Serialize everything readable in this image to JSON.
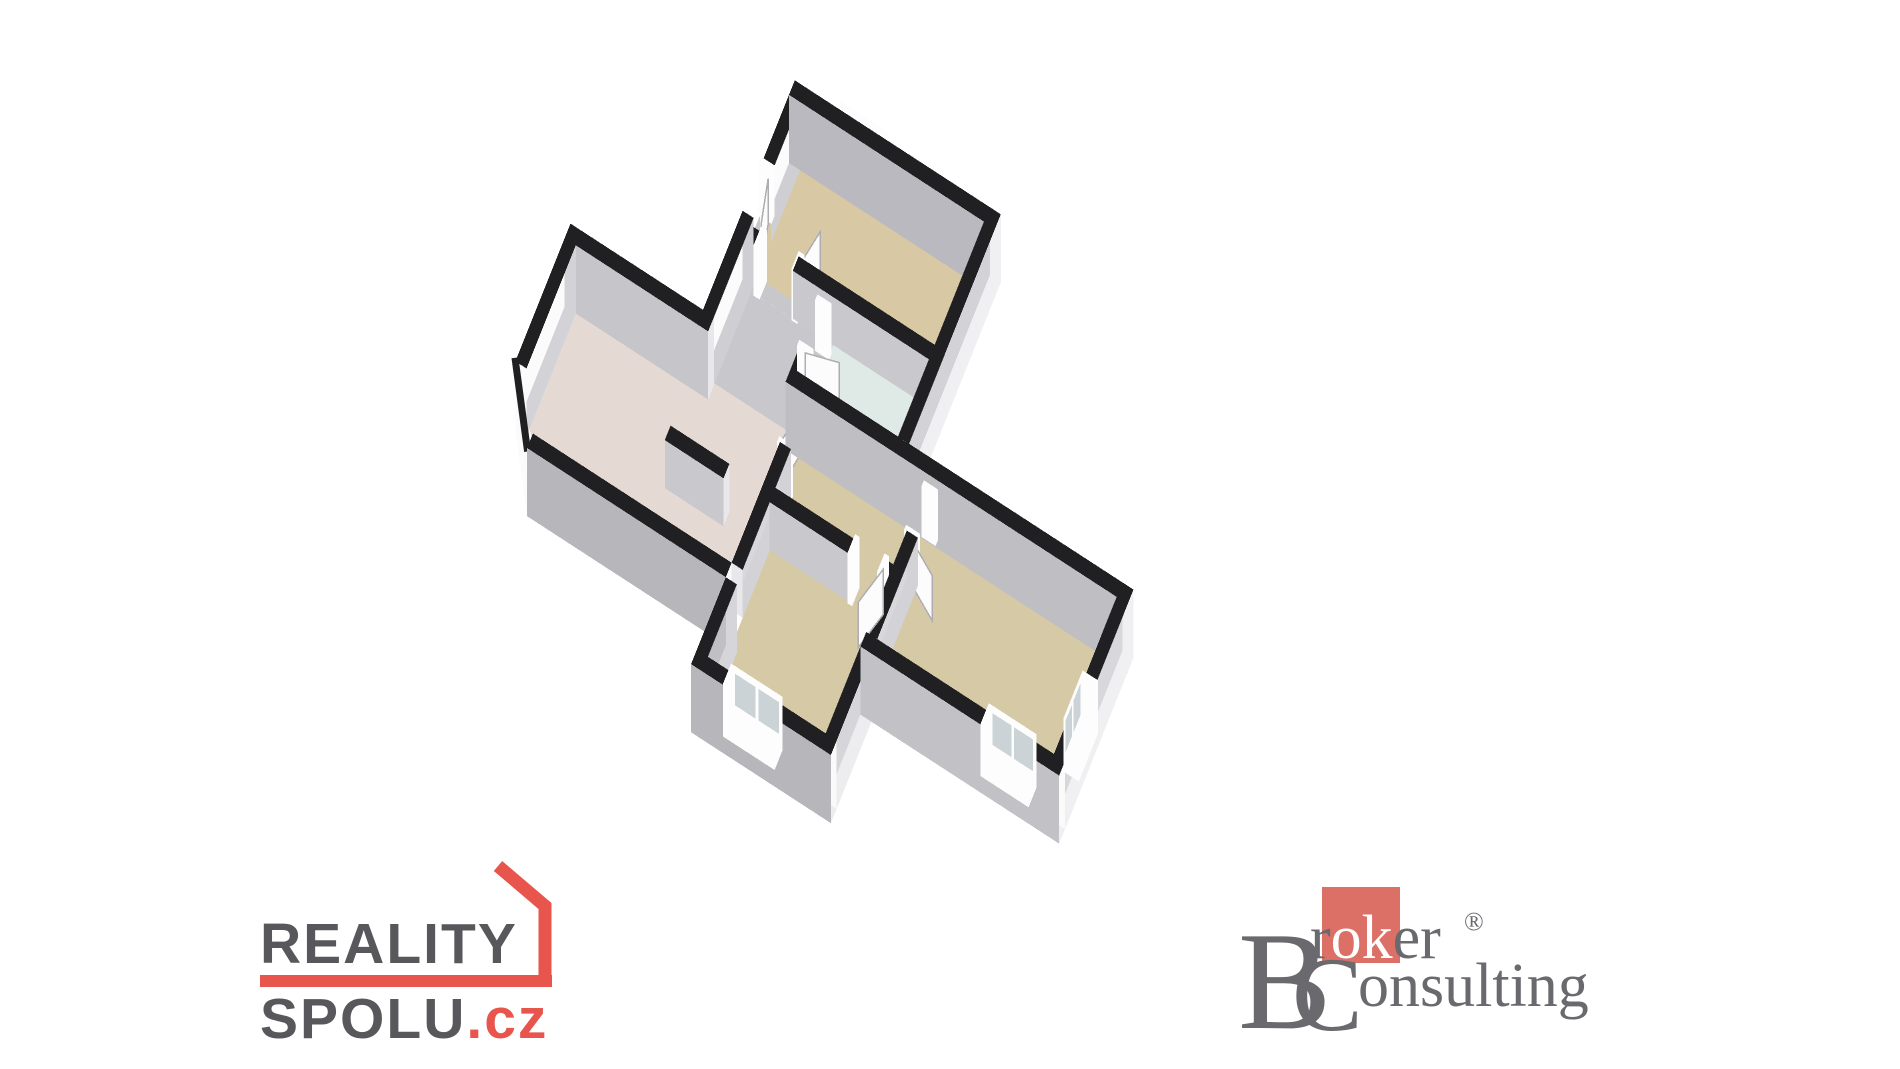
{
  "page": {
    "background": "#ffffff"
  },
  "floorplan": {
    "proj": {
      "ox": 800,
      "oy": 150,
      "s": 46,
      "ux": 0.8,
      "uy": 0.52,
      "vx": -0.42,
      "vy": 1.05,
      "h": 48,
      "ext": 0.42
    },
    "colors": {
      "wall_top": "#202022",
      "frame": "#fdfdfd",
      "pane": "#ccd3d6",
      "leaf": "#fcfcfc",
      "leaf_edge": "#aeaeb2",
      "floor_tan": "#d6c9a6",
      "floor_kitchen": "#d8c9a4",
      "floor_pink": "#e5d9d3",
      "floor_gray": "#c8c8cc",
      "floor_blue": "#dfe9e5"
    },
    "rooms": [
      {
        "name": "kitchen",
        "fill": "#d8c9a4",
        "rect": [
          0,
          0,
          5.0,
          2.55
        ]
      },
      {
        "name": "entry-hall",
        "fill": "#c8c8cc",
        "rect": [
          0,
          2.85,
          2.1,
          4.45
        ]
      },
      {
        "name": "hall-junction",
        "fill": "#c8c8cc",
        "rect": [
          0,
          4.45,
          2.1,
          4.75
        ]
      },
      {
        "name": "hall-kitchen-doorway",
        "fill": "#c8c8cc",
        "rect": [
          0.4,
          2.55,
          1.3,
          2.85
        ]
      },
      {
        "name": "entrance-doorway",
        "fill": "#c8c8cc",
        "rect": [
          -0.3,
          1.5,
          0,
          2.4
        ]
      },
      {
        "name": "bathroom-doorway",
        "fill": "#c8c8cc",
        "rect": [
          2.1,
          3.1,
          2.4,
          4.0
        ]
      },
      {
        "name": "bathroom",
        "fill": "#dfe9e5",
        "rect": [
          2.4,
          2.85,
          5.0,
          4.45
        ]
      },
      {
        "name": "living-room",
        "fill": "#e5d9d3",
        "poly": [
          [
            -3.6,
            4.75
          ],
          [
            2.5,
            4.75
          ],
          [
            2.5,
            8.3
          ],
          [
            -2.6,
            8.3
          ],
          [
            -3.6,
            7.3
          ]
        ]
      },
      {
        "name": "corridor",
        "fill": "#d6c9a6",
        "rect": [
          2.8,
          4.75,
          6.0,
          6.6
        ]
      },
      {
        "name": "living-doorway",
        "fill": "#d6c9a6",
        "rect": [
          2.5,
          4.9,
          2.8,
          5.8
        ]
      },
      {
        "name": "bedroom2-doorway",
        "fill": "#d6c9a6",
        "rect": [
          6.0,
          5.0,
          6.3,
          5.9
        ]
      },
      {
        "name": "bedroom1-doorway",
        "fill": "#d6c9a6",
        "rect": [
          5.0,
          6.6,
          5.8,
          6.9
        ]
      },
      {
        "name": "bedroom-1",
        "fill": "#d6c9a6",
        "rect": [
          2.8,
          6.9,
          6.0,
          10.1
        ]
      },
      {
        "name": "bedroom-2",
        "fill": "#d6c9a6",
        "rect": [
          6.3,
          4.75,
          11.1,
          8.0
        ]
      }
    ],
    "walls": [
      {
        "name": "upper-north",
        "x0": -0.3,
        "x1": 5.3,
        "y0": -0.3,
        "y1": 0,
        "ext": true,
        "n": "#fbfbfb",
        "s": "#b9b9bf",
        "e": "#f0f0f2"
      },
      {
        "name": "upper-west-a",
        "x0": -0.3,
        "x1": 0,
        "y0": -0.3,
        "y1": 1.5,
        "ext": true,
        "w": "#fbfbfb",
        "e": "#cfcfd3"
      },
      {
        "name": "upper-west-b",
        "x0": -0.3,
        "x1": 0,
        "y0": 2.4,
        "y1": 4.45,
        "ext": true,
        "w": "#fbfbfb",
        "e": "#cfcfd3",
        "n": "#f5f5f7"
      },
      {
        "name": "upper-east",
        "x0": 5.0,
        "x1": 5.3,
        "y0": -0.3,
        "y1": 4.45,
        "ext": true,
        "w": "#d3d3d7",
        "e": "#f0f0f2",
        "s": "#e8e8ea"
      },
      {
        "name": "main-north-w",
        "x0": -3.9,
        "x1": 0,
        "y0": 4.45,
        "y1": 4.75,
        "ext": true,
        "n": "#fbfbfb",
        "s": "#c6c6ca",
        "w": "#fafafa",
        "e": "#e8e8ea"
      },
      {
        "name": "main-north-e",
        "x0": 2.1,
        "x1": 11.4,
        "y0": 4.45,
        "y1": 4.75,
        "ext": true,
        "n": "#fbfbfb",
        "s": "#bfbfc3",
        "e": "#f0f0f2",
        "w": "#e8e8ea"
      },
      {
        "name": "main-west",
        "x0": -3.9,
        "x1": -3.6,
        "y0": 4.75,
        "y1": 7.3,
        "ext": true,
        "w": "#fbfbfb",
        "e": "#d3d3d7"
      },
      {
        "name": "living-south",
        "x0": -2.9,
        "x1": 2.5,
        "y0": 8.3,
        "y1": 8.6,
        "ext": true,
        "n": "#fafafa",
        "s": "#b7b7bb",
        "w": "#f5f5f7"
      },
      {
        "name": "bed1-west-ext",
        "x0": 2.5,
        "x1": 2.8,
        "y0": 8.6,
        "y1": 10.4,
        "ext": true,
        "w": "#c0c0c4",
        "e": "#d6d6da"
      },
      {
        "name": "bed1-south",
        "x0": 2.5,
        "x1": 6.3,
        "y0": 10.1,
        "y1": 10.4,
        "ext": true,
        "n": "#fafafa",
        "s": "#b7b7bb"
      },
      {
        "name": "bed1-east",
        "x0": 6.0,
        "x1": 6.3,
        "y0": 8.3,
        "y1": 10.4,
        "ext": true,
        "w": "#d6d6da",
        "e": "#ededef",
        "s": "#e8e8ea"
      },
      {
        "name": "bed2-south",
        "x0": 6.0,
        "x1": 11.4,
        "y0": 8.0,
        "y1": 8.3,
        "ext": true,
        "n": "#fafafa",
        "s": "#c2c2c6"
      },
      {
        "name": "bed2-east",
        "x0": 11.1,
        "x1": 11.4,
        "y0": 4.45,
        "y1": 8.3,
        "ext": true,
        "w": "#d8d8dc",
        "e": "#f0f0f2"
      },
      {
        "name": "kitchen-south-a",
        "x0": 0,
        "x1": 0.4,
        "y0": 2.55,
        "y1": 2.85,
        "n": "#fafafa",
        "s": "#c9c9cd",
        "e": "#e8e8ea"
      },
      {
        "name": "kitchen-south-b",
        "x0": 1.3,
        "x1": 5.0,
        "y0": 2.55,
        "y1": 2.85,
        "n": "#fafafa",
        "s": "#c9c9cd",
        "w": "#e8e8ea"
      },
      {
        "name": "hall-bath-a",
        "x0": 2.1,
        "x1": 2.4,
        "y0": 2.85,
        "y1": 3.1,
        "w": "#d8d8dc",
        "e": "#cfcfd3",
        "s": "#e8e8ea"
      },
      {
        "name": "hall-bath-b",
        "x0": 2.1,
        "x1": 2.4,
        "y0": 4.0,
        "y1": 4.45,
        "w": "#d8d8dc",
        "e": "#cfcfd3",
        "n": "#f5f5f7"
      },
      {
        "name": "living-corr-a",
        "x0": 2.5,
        "x1": 2.8,
        "y0": 4.75,
        "y1": 4.9,
        "w": "#d8d8dc",
        "e": "#d3d3d7"
      },
      {
        "name": "living-corr-b",
        "x0": 2.5,
        "x1": 2.8,
        "y0": 5.8,
        "y1": 8.3,
        "w": "#d8d8dc",
        "e": "#d3d3d7",
        "n": "#f5f5f7",
        "s": "#e8e8ea"
      },
      {
        "name": "corr-bed1-a",
        "x0": 2.8,
        "x1": 5.0,
        "y0": 6.6,
        "y1": 6.9,
        "n": "#fafafa",
        "s": "#c9c9cd",
        "e": "#e8e8ea"
      },
      {
        "name": "corr-bed1-b",
        "x0": 5.8,
        "x1": 6.0,
        "y0": 6.6,
        "y1": 6.9,
        "n": "#fafafa",
        "s": "#c9c9cd",
        "w": "#e8e8ea"
      },
      {
        "name": "corr-bed2-a",
        "x0": 6.0,
        "x1": 6.3,
        "y0": 4.75,
        "y1": 5.0,
        "w": "#d8d8dc",
        "e": "#d3d3d7"
      },
      {
        "name": "corr-bed2-b",
        "x0": 6.0,
        "x1": 6.3,
        "y0": 5.9,
        "y1": 8.0,
        "w": "#d8d8dc",
        "e": "#d3d3d7",
        "n": "#f5f5f7"
      },
      {
        "name": "living-stub",
        "x0": 0.0,
        "x1": 1.6,
        "y0": 6.7,
        "y1": 7.0,
        "n": "#fafafa",
        "s": "#c9c9cd",
        "e": "#e8e8ea",
        "w": "#e8e8ea"
      }
    ],
    "chamfer": {
      "name": "southwest-chamfer",
      "ax": -3.9,
      "ay": 7.3,
      "bx": -2.9,
      "by": 8.6,
      "fill": "#fbfbfb"
    },
    "jambs": [
      {
        "x0": -0.34,
        "x1": 0.02,
        "y0": 1.36,
        "y1": 1.52
      },
      {
        "x0": -0.34,
        "x1": 0.02,
        "y0": 2.38,
        "y1": 2.54
      },
      {
        "x0": 0.26,
        "x1": 0.42,
        "y0": 2.51,
        "y1": 2.89
      },
      {
        "x0": 1.28,
        "x1": 1.44,
        "y0": 2.51,
        "y1": 2.89
      },
      {
        "x0": 2.06,
        "x1": 2.44,
        "y0": 3.02,
        "y1": 3.14
      },
      {
        "x0": 2.06,
        "x1": 2.44,
        "y0": 3.96,
        "y1": 4.08
      },
      {
        "x0": 2.46,
        "x1": 2.84,
        "y0": 4.84,
        "y1": 4.96
      },
      {
        "x0": 2.46,
        "x1": 2.84,
        "y0": 5.76,
        "y1": 5.88
      },
      {
        "x0": 4.94,
        "x1": 5.06,
        "y0": 6.56,
        "y1": 6.94
      },
      {
        "x0": 5.74,
        "x1": 5.86,
        "y0": 6.56,
        "y1": 6.94
      },
      {
        "x0": 5.96,
        "x1": 6.34,
        "y0": 4.94,
        "y1": 5.06
      },
      {
        "x0": 5.96,
        "x1": 6.34,
        "y0": 5.86,
        "y1": 5.98
      }
    ],
    "doors": [
      {
        "name": "entrance-door",
        "hx": -0.05,
        "hy": 1.55,
        "dx": 0.28,
        "dy": 0.96,
        "len": 0.85,
        "ht": 0.94
      },
      {
        "name": "kitchen-door",
        "hx": 1.36,
        "hy": 2.7,
        "dx": 0.2,
        "dy": -0.98,
        "len": 0.85,
        "ht": 0.94
      },
      {
        "name": "bathroom-door",
        "hx": 2.25,
        "hy": 4.02,
        "dx": 0.97,
        "dy": -0.24,
        "len": 0.85,
        "ht": 0.94
      },
      {
        "name": "living-door",
        "hx": 2.65,
        "hy": 4.9,
        "dx": -0.18,
        "dy": 0.98,
        "len": 0.85,
        "ht": 0.94
      },
      {
        "name": "bedroom1-door",
        "hx": 5.8,
        "hy": 6.75,
        "dx": -0.3,
        "dy": 0.95,
        "len": 0.85,
        "ht": 0.94
      },
      {
        "name": "bedroom2-door",
        "hx": 6.15,
        "hy": 5.95,
        "dx": 0.9,
        "dy": 0.44,
        "len": 0.85,
        "ht": 0.94
      }
    ],
    "windows": [
      {
        "name": "kitchen-window",
        "x0": 0.9,
        "x1": 2.2,
        "y0": -0.38,
        "y1": 0.06,
        "z0": 0.12,
        "z1": 1.1,
        "pane": "s"
      },
      {
        "name": "bedroom1-window",
        "x0": 3.4,
        "x1": 4.8,
        "y0": 10.04,
        "y1": 10.46,
        "z0": 0.12,
        "z1": 1.1,
        "pane": "n"
      },
      {
        "name": "bedroom2-window-south",
        "x0": 9.3,
        "x1": 10.6,
        "y0": 7.94,
        "y1": 8.36,
        "z0": 0.12,
        "z1": 1.1,
        "pane": "n"
      },
      {
        "name": "bedroom2-window-east",
        "x0": 11.04,
        "x1": 11.46,
        "y0": 6.4,
        "y1": 7.4,
        "z0": 0.12,
        "z1": 1.1,
        "pane": "w"
      }
    ]
  },
  "logos": {
    "reality": {
      "line1": "REALITY",
      "line2": "SPOLU",
      "suffix": ".cz",
      "text_color": "#58575b",
      "accent_color": "#e8554d"
    },
    "broker": {
      "initial1": "B",
      "word1_pre": "r",
      "word1_mid": "ok",
      "word1_post": "er",
      "registered": "®",
      "initial2": "C",
      "word2": "onsulting",
      "text_color": "#6a6a6e",
      "accent_bg": "#dd7066",
      "mid_color": "#ffffff"
    }
  }
}
